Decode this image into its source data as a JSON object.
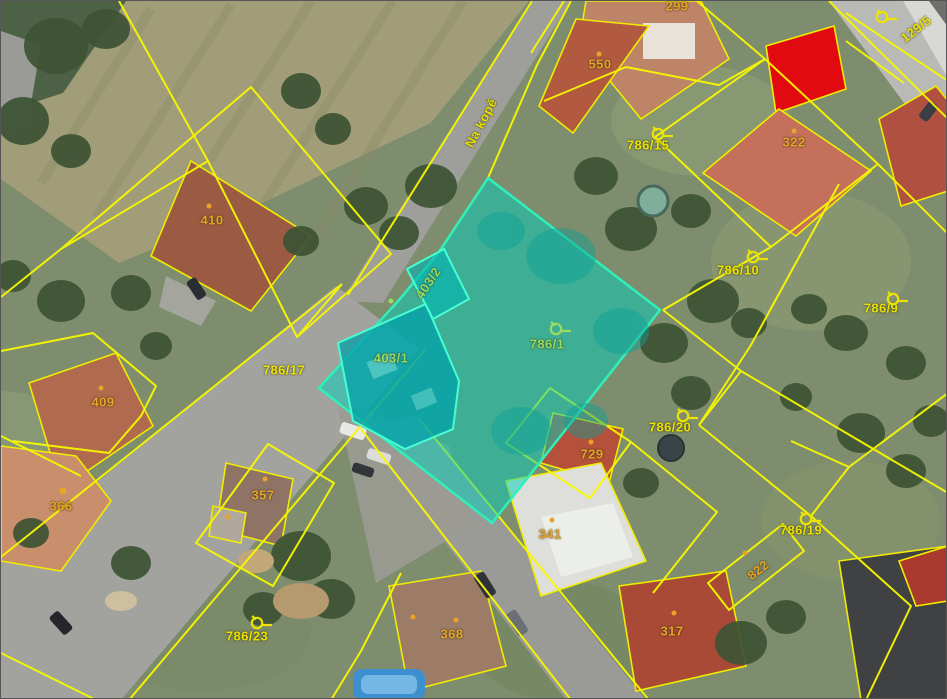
{
  "map": {
    "type": "cadastral-aerial-overlay",
    "street": {
      "name": "Na kopě"
    },
    "selected_parcel": "786/1",
    "selected_buildings": [
      "403/1",
      "403/2"
    ],
    "colors": {
      "parcel_line": "#f8f800",
      "parcel": "#ece400",
      "building": "#e8a428",
      "street": "#e6de00",
      "highlight": "#9adb60",
      "highlight_fill": "#00d2be",
      "highlight_border": "#2ef0b8",
      "selected_building_fill": "#e00a10"
    },
    "labels": [
      {
        "text": "299",
        "x": 676,
        "y": 5,
        "rot": 0,
        "kind": "building"
      },
      {
        "text": "550",
        "x": 599,
        "y": 63,
        "rot": 0,
        "kind": "building"
      },
      {
        "text": "786/15",
        "x": 647,
        "y": 144,
        "rot": 0,
        "kind": "parcel"
      },
      {
        "text": "322",
        "x": 793,
        "y": 141,
        "rot": 0,
        "kind": "building"
      },
      {
        "text": "129/5",
        "x": 915,
        "y": 28,
        "rot": -38,
        "kind": "parcel"
      },
      {
        "text": "410",
        "x": 211,
        "y": 219,
        "rot": 0,
        "kind": "building"
      },
      {
        "text": "Na kopě",
        "x": 480,
        "y": 122,
        "rot": -62,
        "kind": "street"
      },
      {
        "text": "403/2",
        "x": 427,
        "y": 282,
        "rot": -56,
        "kind": "highlight"
      },
      {
        "text": "403/1",
        "x": 390,
        "y": 357,
        "rot": 0,
        "kind": "highlight"
      },
      {
        "text": "786/1",
        "x": 546,
        "y": 343,
        "rot": 0,
        "kind": "highlight"
      },
      {
        "text": "786/17",
        "x": 283,
        "y": 369,
        "rot": 0,
        "kind": "parcel"
      },
      {
        "text": "786/10",
        "x": 737,
        "y": 269,
        "rot": 0,
        "kind": "parcel"
      },
      {
        "text": "786/9",
        "x": 880,
        "y": 307,
        "rot": 0,
        "kind": "parcel"
      },
      {
        "text": "409",
        "x": 102,
        "y": 401,
        "rot": 0,
        "kind": "building"
      },
      {
        "text": "786/20",
        "x": 669,
        "y": 426,
        "rot": 0,
        "kind": "parcel"
      },
      {
        "text": "729",
        "x": 591,
        "y": 453,
        "rot": 0,
        "kind": "building"
      },
      {
        "text": "366",
        "x": 60,
        "y": 505,
        "rot": 0,
        "kind": "building"
      },
      {
        "text": "357",
        "x": 262,
        "y": 494,
        "rot": 0,
        "kind": "building"
      },
      {
        "text": "341",
        "x": 549,
        "y": 533,
        "rot": 0,
        "kind": "building"
      },
      {
        "text": "786/19",
        "x": 800,
        "y": 529,
        "rot": 0,
        "kind": "parcel"
      },
      {
        "text": "822",
        "x": 757,
        "y": 569,
        "rot": -38,
        "kind": "building"
      },
      {
        "text": "786/23",
        "x": 246,
        "y": 635,
        "rot": 0,
        "kind": "parcel"
      },
      {
        "text": "368",
        "x": 451,
        "y": 633,
        "rot": 0,
        "kind": "building"
      },
      {
        "text": "317",
        "x": 671,
        "y": 630,
        "rot": 0,
        "kind": "building"
      }
    ],
    "symbols": [
      {
        "type": "flag",
        "x": 648,
        "y": 122,
        "kind": "parcel"
      },
      {
        "type": "flag",
        "x": 743,
        "y": 245,
        "kind": "parcel"
      },
      {
        "type": "flag",
        "x": 883,
        "y": 287,
        "kind": "parcel"
      },
      {
        "type": "flag",
        "x": 546,
        "y": 317,
        "kind": "highlight"
      },
      {
        "type": "flag",
        "x": 673,
        "y": 404,
        "kind": "parcel"
      },
      {
        "type": "flag",
        "x": 796,
        "y": 507,
        "kind": "parcel"
      },
      {
        "type": "flag",
        "x": 247,
        "y": 611,
        "kind": "parcel"
      },
      {
        "type": "flag",
        "x": 872,
        "y": 5,
        "kind": "parcel"
      },
      {
        "type": "dot",
        "x": 598,
        "y": 53,
        "kind": "building"
      },
      {
        "type": "dot",
        "x": 793,
        "y": 130,
        "kind": "building"
      },
      {
        "type": "dot",
        "x": 208,
        "y": 205,
        "kind": "building"
      },
      {
        "type": "dot",
        "x": 100,
        "y": 387,
        "kind": "building"
      },
      {
        "type": "square-dot",
        "x": 62,
        "y": 490,
        "kind": "building"
      },
      {
        "type": "dot",
        "x": 264,
        "y": 478,
        "kind": "building"
      },
      {
        "type": "dot",
        "x": 227,
        "y": 516,
        "kind": "building"
      },
      {
        "type": "dot",
        "x": 590,
        "y": 441,
        "kind": "building"
      },
      {
        "type": "dot",
        "x": 551,
        "y": 519,
        "kind": "building"
      },
      {
        "type": "dot",
        "x": 412,
        "y": 616,
        "kind": "building"
      },
      {
        "type": "dot",
        "x": 455,
        "y": 619,
        "kind": "building"
      },
      {
        "type": "dot",
        "x": 673,
        "y": 612,
        "kind": "building"
      },
      {
        "type": "dot",
        "x": 744,
        "y": 552,
        "kind": "building"
      },
      {
        "type": "dot",
        "x": 390,
        "y": 300,
        "kind": "highlight"
      }
    ]
  }
}
